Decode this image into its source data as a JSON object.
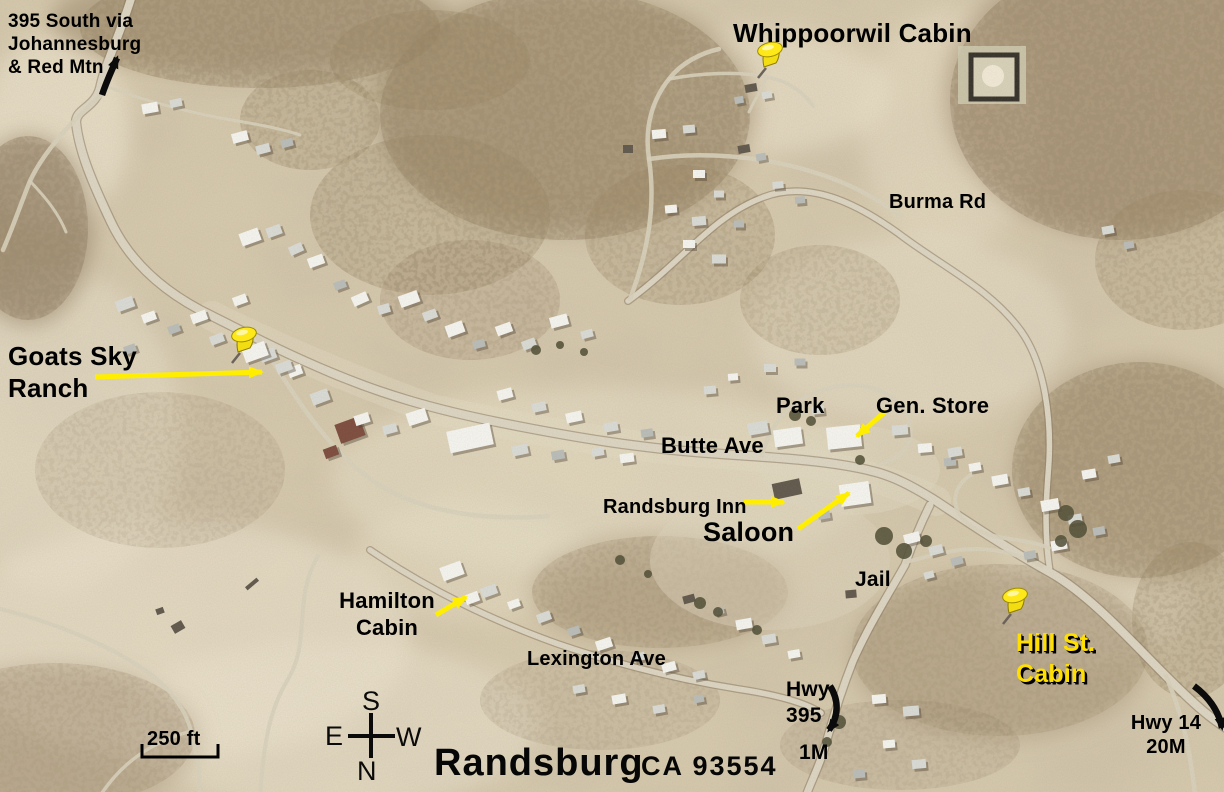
{
  "map": {
    "town": "Randsburg",
    "zip": "CA 93554",
    "scale_bar": {
      "label": "250 ft"
    },
    "compass": {
      "top": "S",
      "left": "E",
      "right": "W",
      "bottom": "N"
    },
    "colors": {
      "label_text": "#000000",
      "highlight_yellow": "#ffee00",
      "pin_yellow": "#ffe81a",
      "hill_label_yellow": "#ffdf00"
    },
    "labels": [
      {
        "id": "label-395-south-note",
        "lines": [
          "395 South via",
          "Johannesburg",
          "& Red Mtn"
        ],
        "x": 8,
        "y": 10,
        "size": 19,
        "align": "left"
      },
      {
        "id": "label-whippoorwil-cabin",
        "lines": [
          "Whippoorwil Cabin"
        ],
        "x": 733,
        "y": 18,
        "size": 26,
        "align": "left"
      },
      {
        "id": "label-burma-rd",
        "lines": [
          "Burma Rd"
        ],
        "x": 889,
        "y": 190,
        "size": 20,
        "align": "left"
      },
      {
        "id": "label-goats-sky-ranch",
        "lines": [
          "Goats Sky",
          "Ranch"
        ],
        "x": 8,
        "y": 341,
        "size": 26,
        "align": "left"
      },
      {
        "id": "label-park",
        "lines": [
          "Park"
        ],
        "x": 776,
        "y": 393,
        "size": 22,
        "align": "left"
      },
      {
        "id": "label-gen-store",
        "lines": [
          "Gen. Store"
        ],
        "x": 876,
        "y": 393,
        "size": 22,
        "align": "left"
      },
      {
        "id": "label-butte-ave",
        "lines": [
          "Butte Ave"
        ],
        "x": 661,
        "y": 433,
        "size": 22,
        "align": "left"
      },
      {
        "id": "label-randsburg-inn",
        "lines": [
          "Randsburg Inn"
        ],
        "x": 603,
        "y": 495,
        "size": 20,
        "align": "left"
      },
      {
        "id": "label-saloon",
        "lines": [
          "Saloon"
        ],
        "x": 703,
        "y": 516,
        "size": 27,
        "align": "left"
      },
      {
        "id": "label-jail",
        "lines": [
          "Jail"
        ],
        "x": 855,
        "y": 567,
        "size": 21,
        "align": "left"
      },
      {
        "id": "label-hamilton-cabin",
        "lines": [
          "Hamilton",
          "Cabin"
        ],
        "x": 330,
        "y": 588,
        "size": 22,
        "align": "center",
        "w": 114
      },
      {
        "id": "label-lexington-ave",
        "lines": [
          "Lexington Ave"
        ],
        "x": 527,
        "y": 647,
        "size": 20,
        "align": "left"
      },
      {
        "id": "label-hill-st-cabin",
        "lines": [
          "Hill St.",
          "Cabin"
        ],
        "x": 1016,
        "y": 628,
        "size": 25,
        "align": "left",
        "color": "#ffdf00",
        "shadow": true
      },
      {
        "id": "label-hwy-395",
        "lines": [
          "Hwy",
          "395"
        ],
        "x": 786,
        "y": 677,
        "size": 21,
        "align": "left"
      },
      {
        "id": "label-1m",
        "lines": [
          "1M"
        ],
        "x": 799,
        "y": 740,
        "size": 21,
        "align": "left"
      },
      {
        "id": "label-hwy-14",
        "lines": [
          "Hwy 14",
          "20M"
        ],
        "x": 1128,
        "y": 711,
        "size": 20,
        "align": "center",
        "w": 76
      }
    ],
    "pins": [
      {
        "id": "pin-whippoorwil",
        "x": 749,
        "y": 40
      },
      {
        "id": "pin-goats-sky-ranch",
        "x": 223,
        "y": 325
      },
      {
        "id": "pin-hill-st",
        "x": 994,
        "y": 586
      }
    ],
    "pointer_arrows": [
      {
        "id": "arrow-goats-sky-ranch",
        "x1": 95,
        "y1": 377,
        "x2": 262,
        "y2": 372
      },
      {
        "id": "arrow-gen-store",
        "x1": 886,
        "y1": 411,
        "x2": 857,
        "y2": 436
      },
      {
        "id": "arrow-randsburg-inn",
        "x1": 744,
        "y1": 502,
        "x2": 784,
        "y2": 502
      },
      {
        "id": "arrow-saloon",
        "x1": 798,
        "y1": 529,
        "x2": 849,
        "y2": 493
      },
      {
        "id": "arrow-hamilton-cabin",
        "x1": 436,
        "y1": 615,
        "x2": 466,
        "y2": 597
      }
    ],
    "route_arrows": [
      {
        "id": "arrow-395-north",
        "d": "M 102,95 C 107,80 112,70 117,58"
      },
      {
        "id": "arrow-hwy-395-south",
        "d": "M 830,686 C 839,700 839,716 829,730"
      },
      {
        "id": "arrow-hwy-14",
        "d": "M 1194,686 C 1210,698 1219,712 1222,728"
      }
    ]
  }
}
